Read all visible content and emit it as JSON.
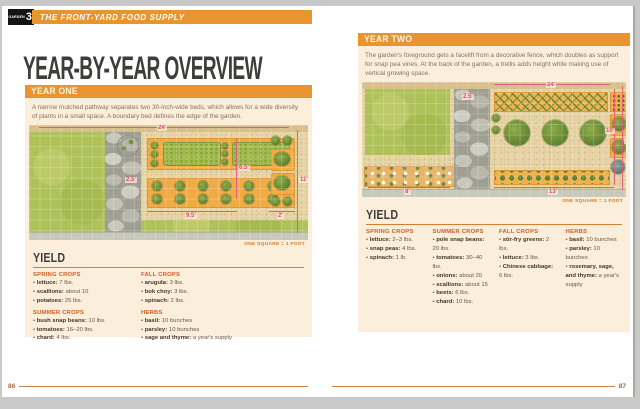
{
  "header": {
    "tab_label": "GARDEN",
    "tab_number": "3",
    "book_title": "THE FRONT-YARD FOOD SUPPLY"
  },
  "title": "YEAR-BY-YEAR OVERVIEW",
  "colors": {
    "accent_orange": "#e8952f",
    "panel_cream": "#fbeeda",
    "crop_heading": "#cf5f2a",
    "dimension_pink": "#e2607f"
  },
  "pages": {
    "left": {
      "section_label": "YEAR ONE",
      "description": "A narrow mulched pathway separates two 30-inch-wide beds, which allows for a wide diversity of plants in a small space. A boundary bed defines the edge of the garden.",
      "diagram": {
        "caption": "ONE SQUARE = 1 FOOT",
        "dims": {
          "top": "24'",
          "right": "11'",
          "mid": "6.5'",
          "path": "2.5'",
          "bottom": "9.5'",
          "side": "2'"
        }
      },
      "yield": {
        "heading": "YIELD",
        "columns": [
          [
            {
              "title": "SPRING CROPS",
              "items": [
                {
                  "name": "lettuce",
                  "value": "7 lbs."
                },
                {
                  "name": "scallions",
                  "value": "about 10"
                },
                {
                  "name": "potatoes",
                  "value": "25 lbs."
                }
              ]
            },
            {
              "title": "SUMMER CROPS",
              "items": [
                {
                  "name": "bush snap beans",
                  "value": "10 lbs."
                },
                {
                  "name": "tomatoes",
                  "value": "16–20 lbs."
                },
                {
                  "name": "chard",
                  "value": "4 lbs."
                }
              ]
            }
          ],
          [
            {
              "title": "FALL CROPS",
              "items": [
                {
                  "name": "arugula",
                  "value": "3 lbs."
                },
                {
                  "name": "bok choy",
                  "value": "3 lbs."
                },
                {
                  "name": "spinach",
                  "value": "2 lbs."
                }
              ]
            },
            {
              "title": "HERBS",
              "items": [
                {
                  "name": "basil",
                  "value": "10 bunches"
                },
                {
                  "name": "parsley",
                  "value": "10 bunches"
                },
                {
                  "name": "sage and thyme",
                  "value": "a year's supply"
                }
              ]
            }
          ]
        ]
      },
      "page_number": "86"
    },
    "right": {
      "section_label": "YEAR TWO",
      "description": "The garden's foreground gets a facelift from a decorative fence, which doubles as support for snap pea vines. At the back of the garden, a trellis adds height while making use of vertical growing space.",
      "diagram": {
        "caption": "ONE SQUARE = 1 FOOT",
        "dims": {
          "top": "24'",
          "right_outer": "11'",
          "right_inner": "10'",
          "path": "2.5'",
          "bottom_left": "8'",
          "bottom": "13'"
        }
      },
      "yield": {
        "heading": "YIELD",
        "columns": [
          [
            {
              "title": "SPRING CROPS",
              "items": [
                {
                  "name": "lettuce",
                  "value": "2–3 lbs."
                },
                {
                  "name": "snap peas",
                  "value": "4 lbs."
                },
                {
                  "name": "spinach",
                  "value": "1 lb."
                }
              ]
            }
          ],
          [
            {
              "title": "SUMMER CROPS",
              "items": [
                {
                  "name": "pole snap beans",
                  "value": "20 lbs."
                },
                {
                  "name": "tomatoes",
                  "value": "30–40 lbs."
                },
                {
                  "name": "onions",
                  "value": "about 20"
                },
                {
                  "name": "scallions",
                  "value": "about 15"
                },
                {
                  "name": "beets",
                  "value": "6 lbs."
                },
                {
                  "name": "chard",
                  "value": "10 lbs."
                }
              ]
            }
          ],
          [
            {
              "title": "FALL CROPS",
              "items": [
                {
                  "name": "stir-fry greens",
                  "value": "2 lbs."
                },
                {
                  "name": "lettuce",
                  "value": "3 lbs."
                },
                {
                  "name": "Chinese cabbage",
                  "value": "6 lbs."
                }
              ]
            }
          ],
          [
            {
              "title": "HERBS",
              "items": [
                {
                  "name": "basil",
                  "value": "10 bunches"
                },
                {
                  "name": "parsley",
                  "value": "10 bunches"
                },
                {
                  "name": "rosemary, sage, and thyme",
                  "value": "a year's supply"
                }
              ]
            }
          ]
        ]
      },
      "page_number": "87"
    }
  }
}
